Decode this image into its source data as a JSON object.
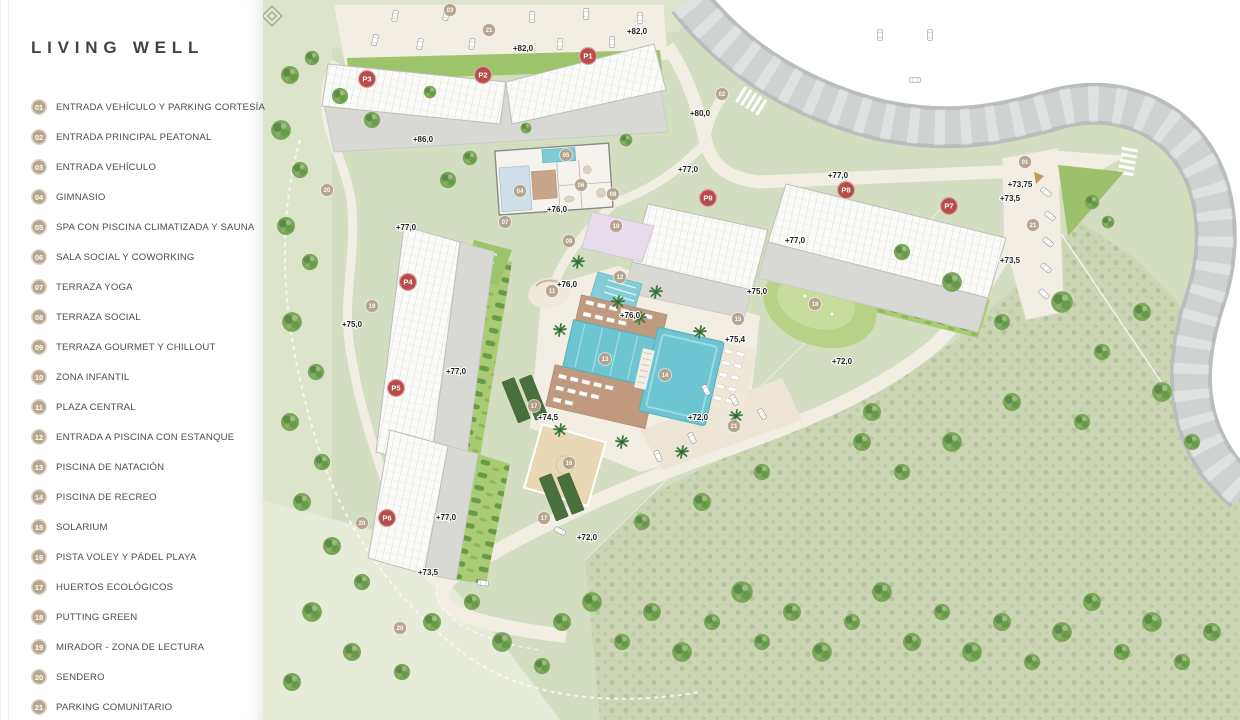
{
  "legend": {
    "title": "LIVING WELL",
    "items": [
      {
        "num": "01",
        "label": "ENTRADA VEHÍCULO Y PARKING CORTESÍA"
      },
      {
        "num": "02",
        "label": "ENTRADA PRINCIPAL PEATONAL"
      },
      {
        "num": "03",
        "label": "ENTRADA VEHÍCULO"
      },
      {
        "num": "04",
        "label": "GIMNASIO"
      },
      {
        "num": "05",
        "label": "SPA CON PISCINA CLIMATIZADA Y SAUNA"
      },
      {
        "num": "06",
        "label": "SALA SOCIAL Y COWORKING"
      },
      {
        "num": "07",
        "label": "TERRAZA YOGA"
      },
      {
        "num": "08",
        "label": "TERRAZA SOCIAL"
      },
      {
        "num": "09",
        "label": "TERRAZA GOURMET Y CHILLOUT"
      },
      {
        "num": "10",
        "label": "ZONA INFANTIL"
      },
      {
        "num": "11",
        "label": "PLAZA CENTRAL"
      },
      {
        "num": "12",
        "label": "ENTRADA A PISCINA CON ESTANQUE"
      },
      {
        "num": "13",
        "label": "PISCINA DE NATACIÓN"
      },
      {
        "num": "14",
        "label": "PISCINA DE RECREO"
      },
      {
        "num": "15",
        "label": "SOLARIUM"
      },
      {
        "num": "16",
        "label": "PISTA VOLEY Y PÁDEL PLAYA"
      },
      {
        "num": "17",
        "label": "HUERTOS ECOLÓGICOS"
      },
      {
        "num": "18",
        "label": "PUTTING GREEN"
      },
      {
        "num": "19",
        "label": "MIRADOR - ZONA DE LECTURA"
      },
      {
        "num": "20",
        "label": "SENDERO"
      },
      {
        "num": "21",
        "label": "PARKING COMUNITARIO"
      }
    ]
  },
  "map": {
    "building_markers": [
      {
        "label": "P1",
        "x": 588,
        "y": 56
      },
      {
        "label": "P2",
        "x": 483,
        "y": 75
      },
      {
        "label": "P3",
        "x": 367,
        "y": 79
      },
      {
        "label": "P4",
        "x": 408,
        "y": 282
      },
      {
        "label": "P5",
        "x": 396,
        "y": 388
      },
      {
        "label": "P6",
        "x": 387,
        "y": 518
      },
      {
        "label": "P7",
        "x": 949,
        "y": 206
      },
      {
        "label": "P8",
        "x": 846,
        "y": 190
      },
      {
        "label": "P9",
        "x": 708,
        "y": 198
      }
    ],
    "poi_markers": [
      {
        "num": "03",
        "x": 450,
        "y": 10
      },
      {
        "num": "21",
        "x": 489,
        "y": 30
      },
      {
        "num": "02",
        "x": 722,
        "y": 94
      },
      {
        "num": "05",
        "x": 566,
        "y": 155
      },
      {
        "num": "01",
        "x": 1025,
        "y": 162
      },
      {
        "num": "06",
        "x": 581,
        "y": 185
      },
      {
        "num": "04",
        "x": 520,
        "y": 191
      },
      {
        "num": "20",
        "x": 327,
        "y": 190
      },
      {
        "num": "08",
        "x": 613,
        "y": 194
      },
      {
        "num": "07",
        "x": 505,
        "y": 222
      },
      {
        "num": "21",
        "x": 1033,
        "y": 225
      },
      {
        "num": "10",
        "x": 616,
        "y": 226
      },
      {
        "num": "09",
        "x": 569,
        "y": 241
      },
      {
        "num": "12",
        "x": 620,
        "y": 277
      },
      {
        "num": "11",
        "x": 552,
        "y": 291
      },
      {
        "num": "18",
        "x": 815,
        "y": 304
      },
      {
        "num": "19",
        "x": 372,
        "y": 306
      },
      {
        "num": "15",
        "x": 738,
        "y": 319
      },
      {
        "num": "13",
        "x": 605,
        "y": 359
      },
      {
        "num": "14",
        "x": 665,
        "y": 375
      },
      {
        "num": "17",
        "x": 534,
        "y": 406
      },
      {
        "num": "21",
        "x": 734,
        "y": 426
      },
      {
        "num": "16",
        "x": 569,
        "y": 463
      },
      {
        "num": "17",
        "x": 544,
        "y": 518
      },
      {
        "num": "20",
        "x": 362,
        "y": 523
      },
      {
        "num": "20",
        "x": 400,
        "y": 628
      }
    ],
    "elevation_labels": [
      {
        "text": "+82,0",
        "x": 523,
        "y": 51
      },
      {
        "text": "+82,0",
        "x": 637,
        "y": 34
      },
      {
        "text": "+86,0",
        "x": 423,
        "y": 142
      },
      {
        "text": "+80,0",
        "x": 700,
        "y": 116
      },
      {
        "text": "+77,0",
        "x": 688,
        "y": 172
      },
      {
        "text": "+77,0",
        "x": 838,
        "y": 178
      },
      {
        "text": "+73,75",
        "x": 1020,
        "y": 187
      },
      {
        "text": "+73,5",
        "x": 1010,
        "y": 201
      },
      {
        "text": "+77,0",
        "x": 795,
        "y": 243
      },
      {
        "text": "+73,5",
        "x": 1010,
        "y": 263
      },
      {
        "text": "+76,0",
        "x": 557,
        "y": 212
      },
      {
        "text": "+77,0",
        "x": 406,
        "y": 230
      },
      {
        "text": "+75,0",
        "x": 352,
        "y": 327
      },
      {
        "text": "+76,0",
        "x": 567,
        "y": 287
      },
      {
        "text": "+75,0",
        "x": 757,
        "y": 294
      },
      {
        "text": "+76,0",
        "x": 630,
        "y": 318
      },
      {
        "text": "+75,4",
        "x": 735,
        "y": 342
      },
      {
        "text": "+77,0",
        "x": 456,
        "y": 374
      },
      {
        "text": "+72,0",
        "x": 842,
        "y": 364
      },
      {
        "text": "+74,5",
        "x": 548,
        "y": 420
      },
      {
        "text": "+72,0",
        "x": 698,
        "y": 420
      },
      {
        "text": "+77,0",
        "x": 446,
        "y": 520
      },
      {
        "text": "+72,0",
        "x": 587,
        "y": 540
      },
      {
        "text": "+73,5",
        "x": 428,
        "y": 575
      }
    ],
    "colors": {
      "building_marker": "#b84c49",
      "poi_marker": "#b3a28a",
      "pool": "#6ec5d2",
      "deck": "#c09a7e",
      "grass": "#d3dec1",
      "lawn": "#a9cb74",
      "road": "#c6cbca",
      "path": "#f3eee4",
      "sand": "#e8d8b6",
      "kids_zone": "#e6dcea",
      "orchard": "#49703c"
    }
  }
}
